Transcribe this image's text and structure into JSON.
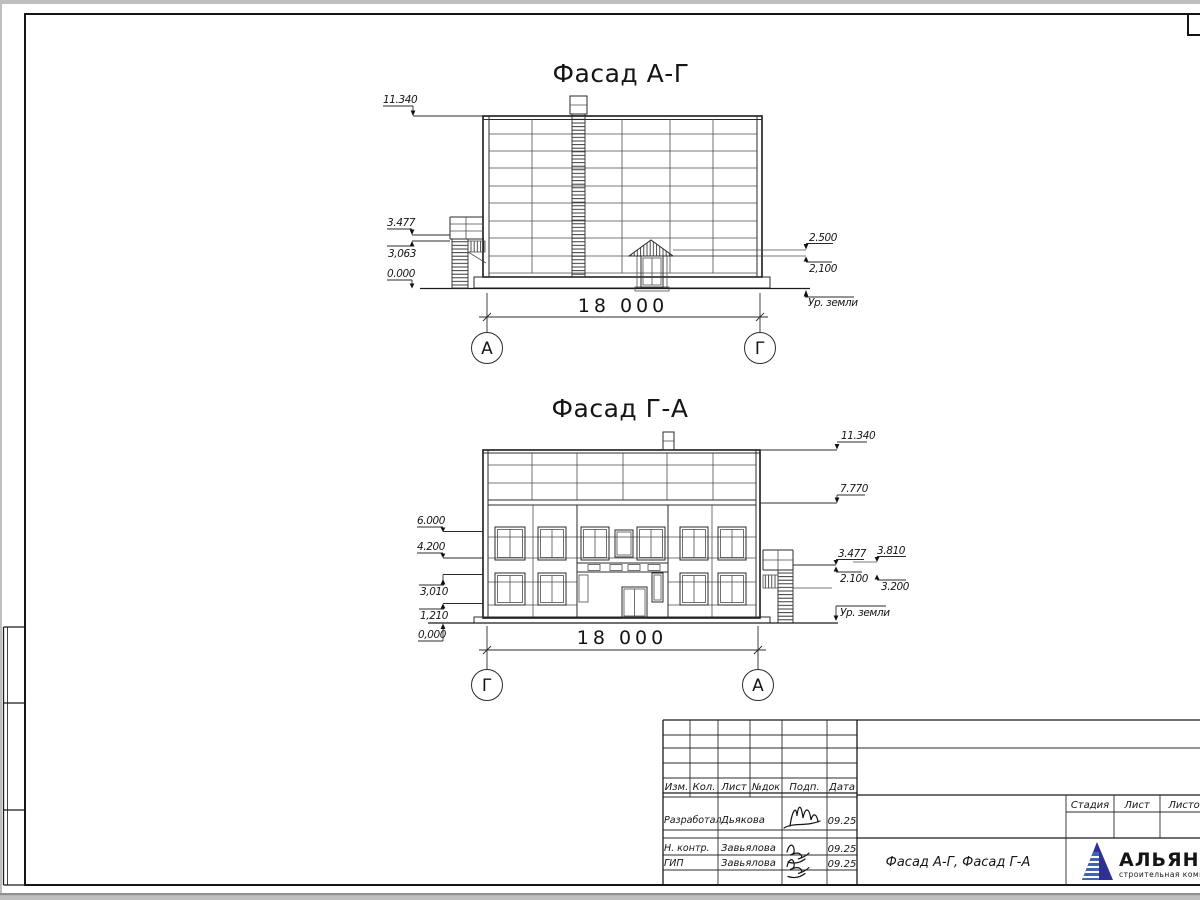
{
  "sheet": {
    "facade1": {
      "title": "Фасад А-Г",
      "width_dim": "18 000",
      "axis_left": "А",
      "axis_right": "Г",
      "levels_left": [
        "11.340",
        "3.477",
        "3,063",
        "0.000"
      ],
      "levels_right": [
        "2.500",
        "2,100"
      ],
      "ground_label": "Ур. земли"
    },
    "facade2": {
      "title": "Фасад Г-А",
      "width_dim": "18 000",
      "axis_left": "Г",
      "axis_right": "А",
      "levels_left": [
        "6.000",
        "4.200",
        "3,010",
        "1,210",
        "0,000"
      ],
      "levels_right": [
        "11.340",
        "7.770",
        "3.477",
        "3.810",
        "2.100",
        "3.200"
      ],
      "ground_label": "Ур. земли"
    },
    "titleblock": {
      "revision_header": [
        "Изм.",
        "Кол.",
        "Лист",
        "№док",
        "Подп.",
        "Дата"
      ],
      "rows": [
        {
          "role": "Разработал",
          "name": "Дьякова",
          "date": "09.25"
        },
        {
          "role": "Н. контр.",
          "name": "Завьялова",
          "date": "09.25"
        },
        {
          "role": "ГИП",
          "name": "Завьялова",
          "date": "09.25"
        }
      ],
      "doc_title": "Фасад А-Г, Фасад Г-А",
      "stage_header": [
        "Стадия",
        "Лист",
        "Листов"
      ],
      "logo": {
        "name": "АЛЬЯНС",
        "subtitle": "строительная компания",
        "brand_color": "#2e3192",
        "subtitle_color": "#4a9ad4"
      }
    }
  }
}
